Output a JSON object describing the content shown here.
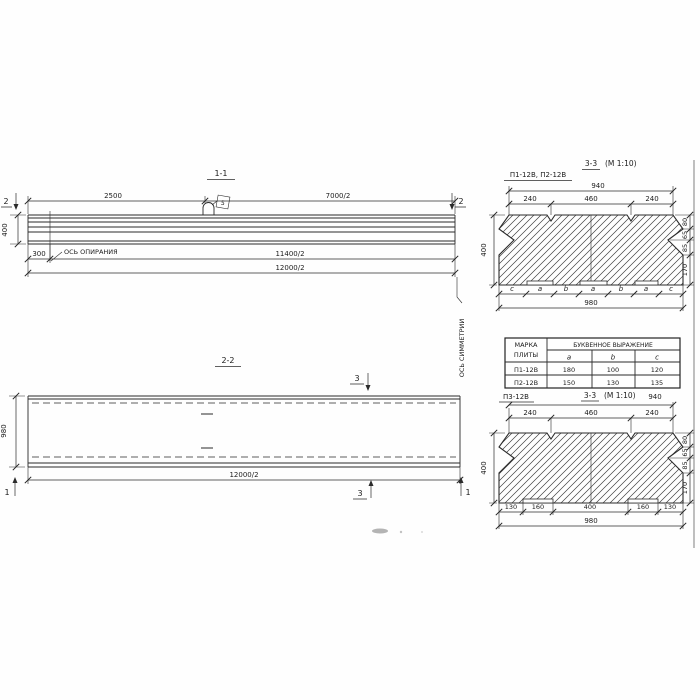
{
  "drawing": {
    "elev": {
      "title": "1-1",
      "dim_2500": "2500",
      "dim_7000": "7000/2",
      "dim_300": "300",
      "dim_11400": "11400/2",
      "dim_12000": "12000/2",
      "dim_height": "400",
      "bearing_axis": "ОСЬ ОПИРАНИЯ",
      "loop_tag": "5",
      "cut_left": "2",
      "cut_right": "2"
    },
    "plan": {
      "title": "2-2",
      "dim_width": "980",
      "dim_length": "12000/2",
      "cut_3_top": "3",
      "cut_3_bottom": "3",
      "cut_1_left": "1",
      "cut_1_right": "1"
    },
    "symmetry_axis": "ОСЬ СИММЕТРИИ",
    "secA": {
      "plates": "П1-12В, П2-12В",
      "title_cut": "3-3",
      "title_scale": "(М 1:10)",
      "dim_940": "940",
      "dim_240a": "240",
      "dim_460": "460",
      "dim_240b": "240",
      "dim_400": "400",
      "right_dims": [
        "80",
        "65",
        "85",
        "170"
      ],
      "letters": [
        "c",
        "a",
        "b",
        "a",
        "b",
        "a",
        "c"
      ],
      "dim_980": "980"
    },
    "secB": {
      "plate": "П3-12В",
      "title_cut": "3-3",
      "title_scale": "(М 1:10)",
      "dim_940": "940",
      "dim_240a": "240",
      "dim_460": "460",
      "dim_240b": "240",
      "dim_400": "400",
      "right_dims": [
        "80",
        "65",
        "85",
        "170"
      ],
      "bottom_dims": [
        "130",
        "160",
        "400",
        "160",
        "130"
      ],
      "dim_980": "980"
    },
    "table": {
      "h_mark_1": "МАРКА",
      "h_mark_2": "ПЛИТЫ",
      "h_expr": "БУКВЕННОЕ  ВЫРАЖЕНИЕ",
      "h_a": "a",
      "h_b": "b",
      "h_c": "c",
      "rows": [
        {
          "mark": "П1-12В",
          "a": "180",
          "b": "100",
          "c": "120"
        },
        {
          "mark": "П2-12В",
          "a": "150",
          "b": "130",
          "c": "135"
        }
      ]
    }
  }
}
